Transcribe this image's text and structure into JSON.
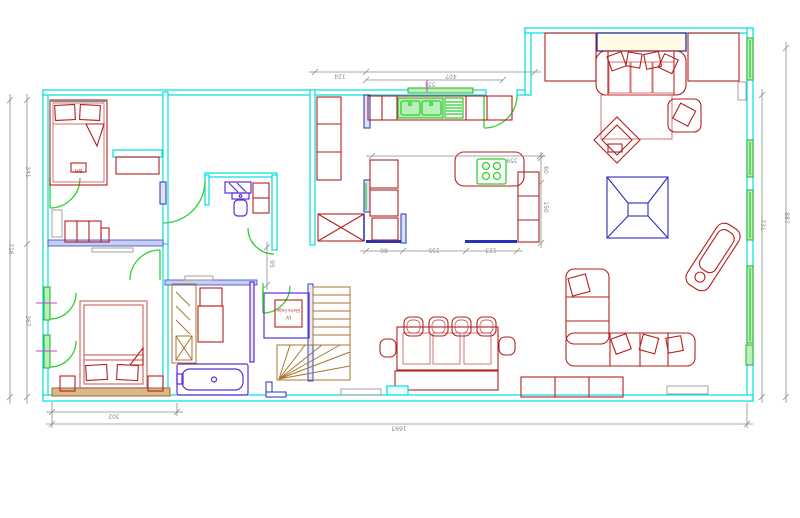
{
  "drawing": {
    "type": "architectural floor plan"
  },
  "dims": {
    "top": {
      "left": "124",
      "right": "407",
      "sub": "331"
    },
    "left": {
      "overall": "716",
      "upper": "341",
      "lower": "367"
    },
    "right": {
      "inner": "731",
      "outer": "887"
    },
    "bottom": {
      "left": "302",
      "overall": "1693"
    },
    "interior": {
      "hall": "95",
      "clearance": "359",
      "gap": "60",
      "counter": "150",
      "seg_a": "80",
      "seg_b": "155",
      "seg_c": "123"
    }
  },
  "labels": {
    "laundry_line1": "Sèche-linge",
    "laundry_line2": "LV",
    "bed_tag": "BH"
  },
  "palette": {
    "wall_cyan": "#00dede",
    "furniture_red": "#b51f1f",
    "bed_soft_red": "#cd6f6f",
    "door_green": "#2fd22f",
    "window_green": "#22b022",
    "fixture_purple": "#5a2fd2",
    "deep_blue": "#2233bb",
    "skylight_blue": "#2b2bcb",
    "stairs_tan": "#a8762e",
    "dimension_gray": "#8a8a8a",
    "magenta": "#cc3ecc"
  }
}
